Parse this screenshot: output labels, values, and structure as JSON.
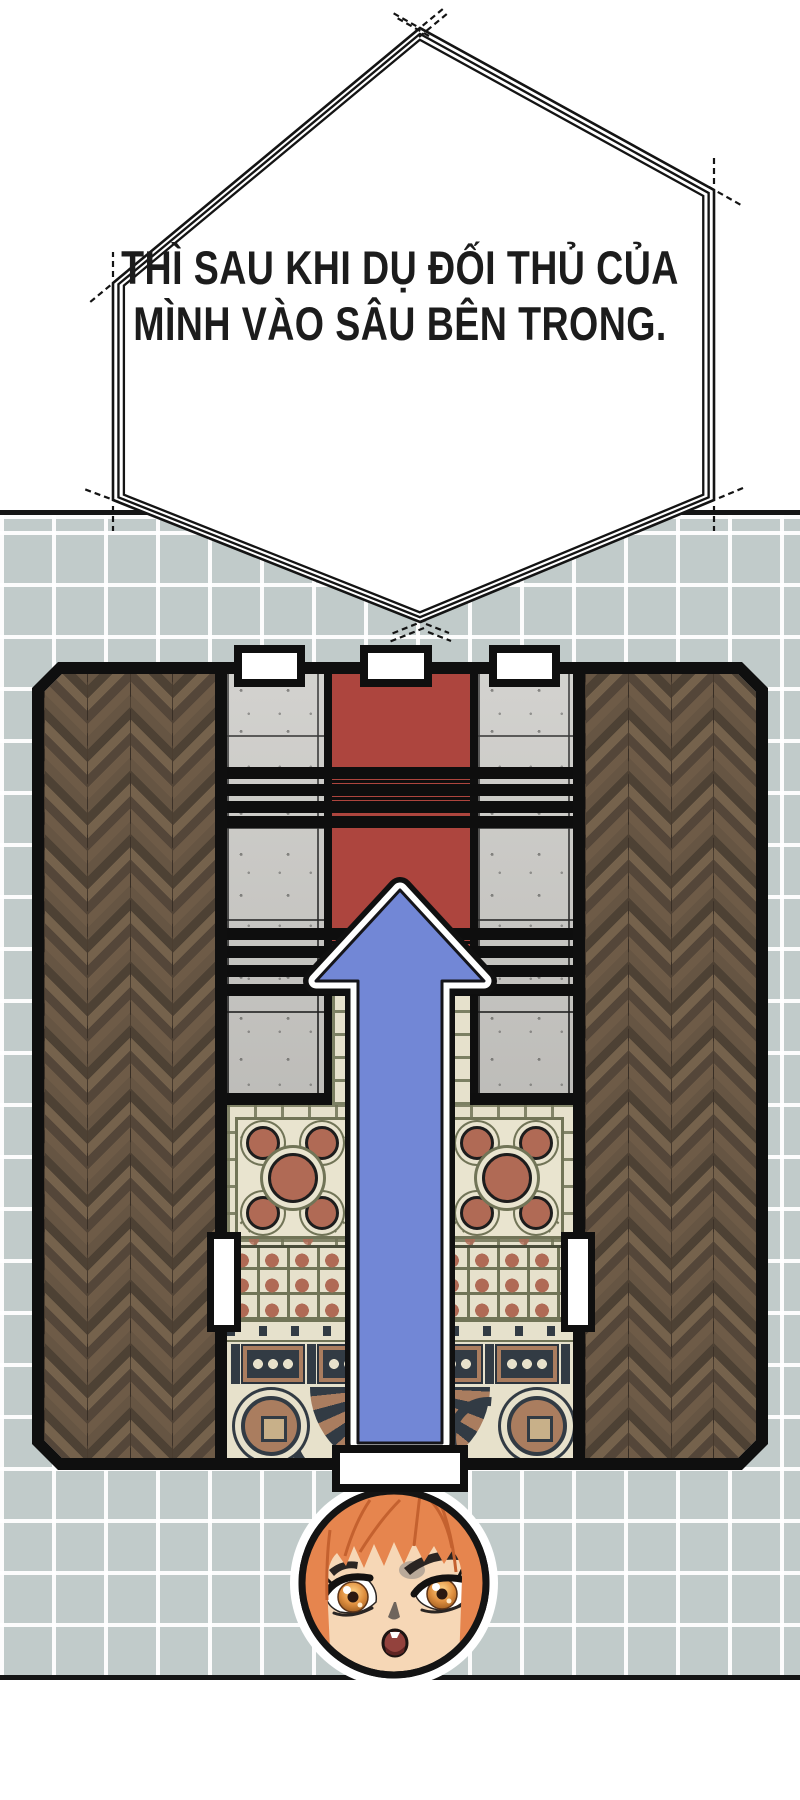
{
  "bubble": {
    "text_line_1": "THÌ SAU KHI DỤ ĐỐI THỦ CỦA",
    "text_line_2": "MÌNH VÀO SÂU BÊN TRONG.",
    "text_color": "#1c1c1c",
    "fill": "#ffffff",
    "border_color": "#141414"
  },
  "scene": {
    "wall_tile_color": "#c1cbca",
    "grout_color": "#ffffff",
    "panel_end_line_color": "#151515",
    "floor_plan": {
      "outer_border_color": "#0f0f0f",
      "wood_floor_style": "herringbone",
      "wood_colors": [
        "#6e5b47",
        "#544639",
        "#75624c",
        "#4d4134"
      ],
      "concrete_color": "#c9c8c4",
      "carpet_color": "#ad453e",
      "stair_stripe_color": "#0e0e0e",
      "mosaic_colors": {
        "base": "#e6e1cc",
        "line": "#717457",
        "accent": "#b06a55",
        "navy": "#323b44",
        "tan": "#aa7d5f"
      },
      "top_door_count": 3,
      "bottom_door_count": 1,
      "side_handle_count": 2,
      "door_color": "#ffffff"
    },
    "arrow": {
      "direction": "up",
      "fill": "#7287d6",
      "inner_outline": "#ffffff",
      "outer_outline": "#101010"
    },
    "character": {
      "hair_color": "#e6854e",
      "skin_color": "#f6d7b6",
      "eye_color": "#e09040",
      "mouth_state": "open",
      "outline_color": "#141414",
      "halo_color": "#ffffff"
    }
  }
}
